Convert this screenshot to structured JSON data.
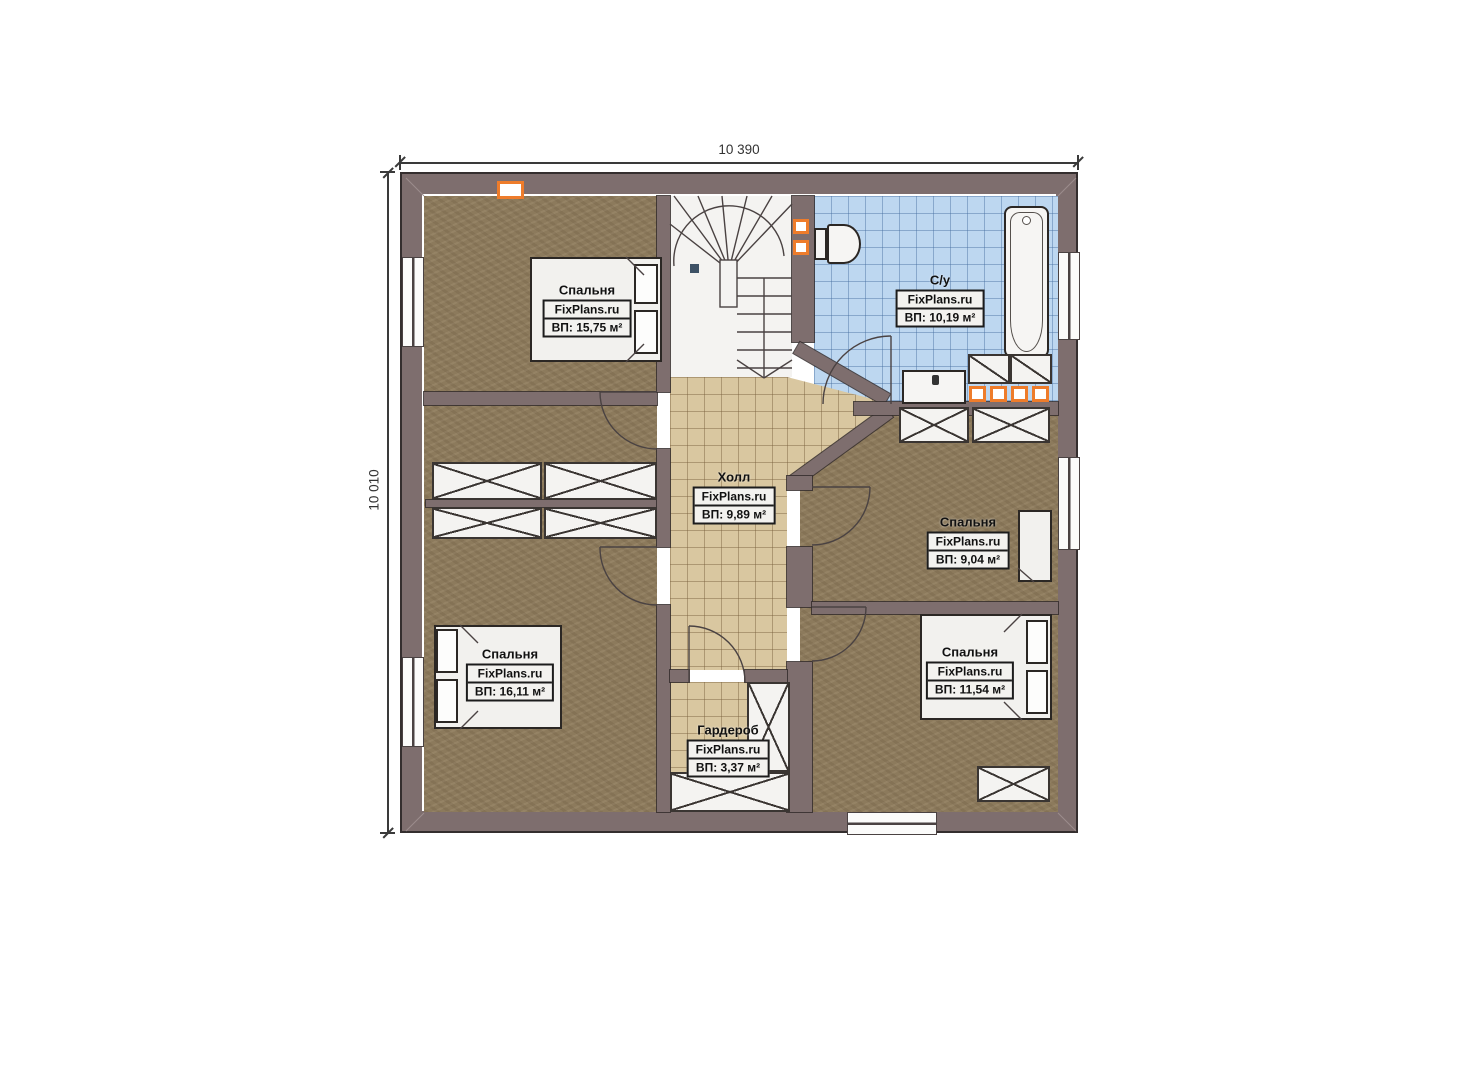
{
  "plan": {
    "brand": "FixPlans.ru",
    "dimensions": {
      "width_mm": "10 390",
      "height_mm": "10 010"
    },
    "rooms": [
      {
        "name": "Спальня",
        "area": "ВП: 15,75 м²"
      },
      {
        "name": "С/у",
        "area": "ВП: 10,19 м²"
      },
      {
        "name": "Холл",
        "area": "ВП: 9,89 м²"
      },
      {
        "name": "Спальня",
        "area": "ВП: 9,04 м²"
      },
      {
        "name": "Спальня",
        "area": "ВП: 16,11 м²"
      },
      {
        "name": "Спальня",
        "area": "ВП: 11,54 м²"
      },
      {
        "name": "Гардероб",
        "area": "ВП: 3,37 м²"
      }
    ],
    "colors": {
      "wall": "#7e6e6e",
      "floor_wood": "#8c7a5c",
      "floor_tile_hall": "#d9c7a0",
      "floor_tile_bath": "#bdd7f0",
      "accent_orange": "#ee7c2b"
    }
  }
}
